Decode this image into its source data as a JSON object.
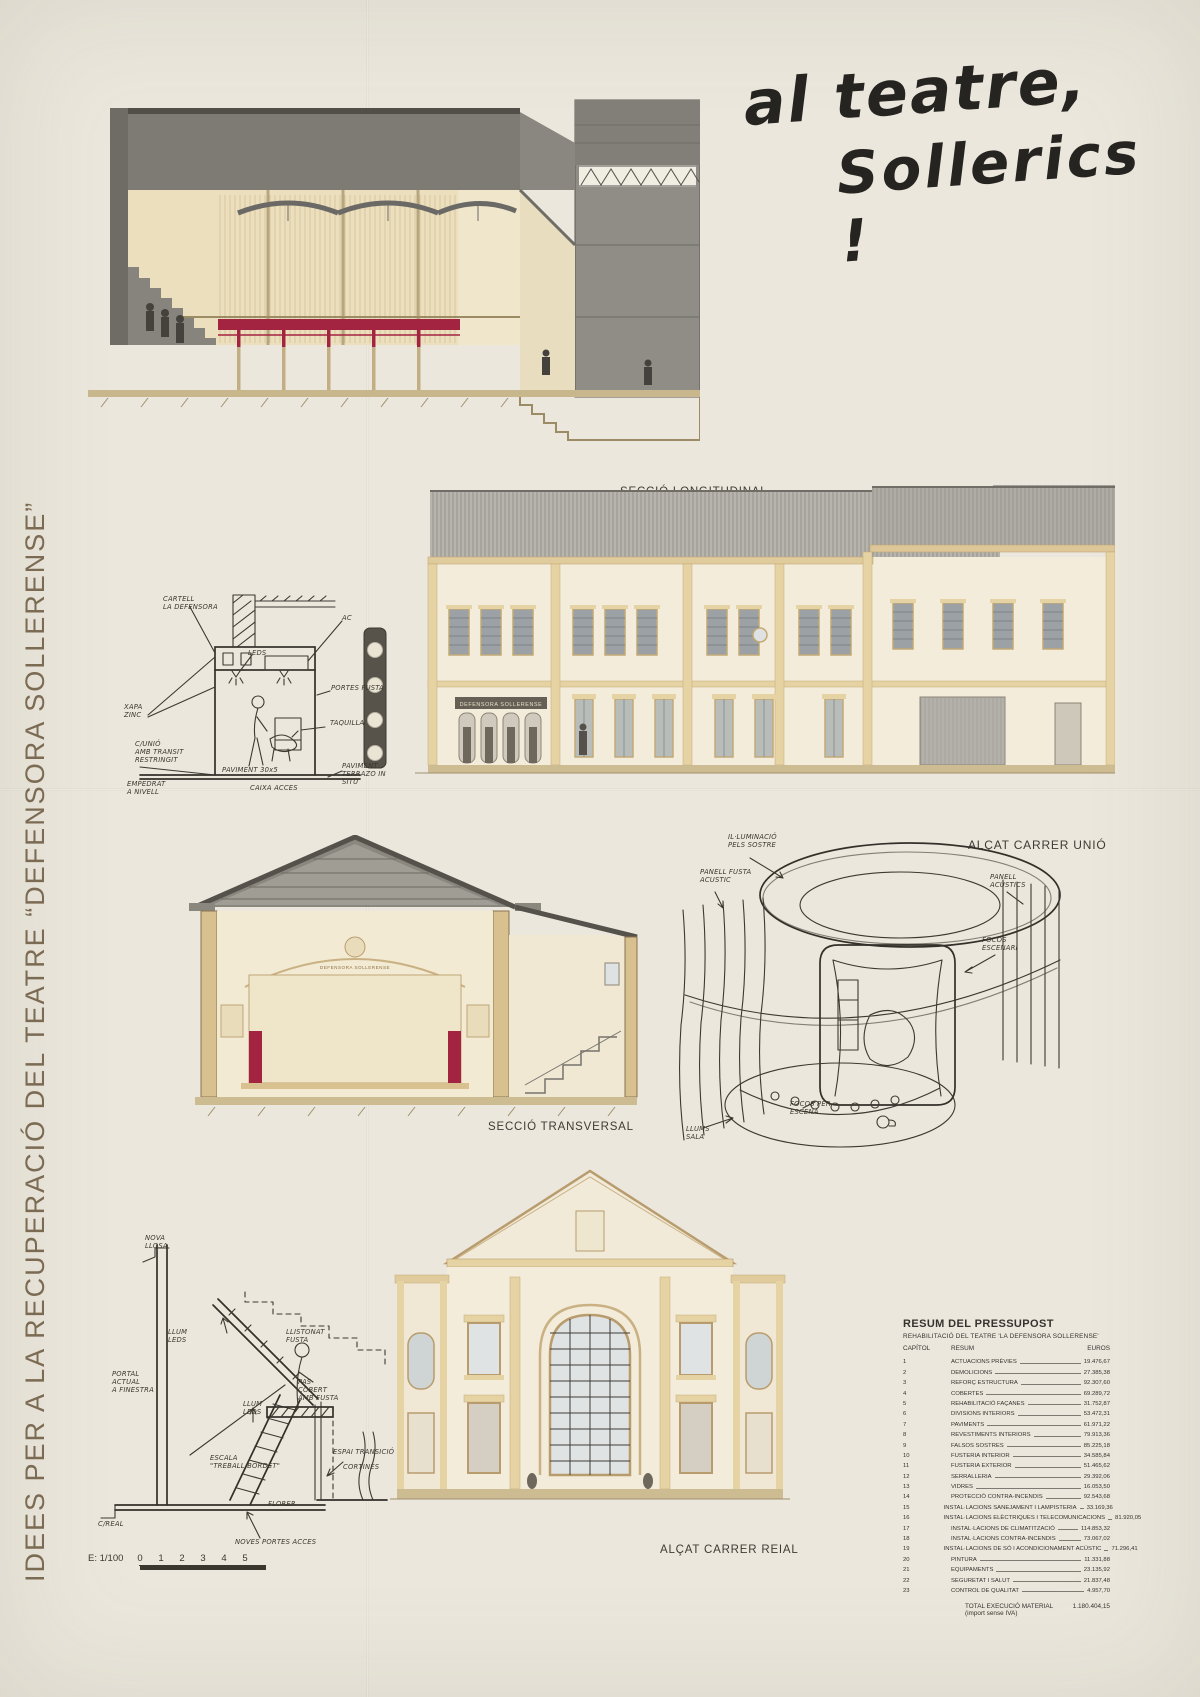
{
  "side_title": "IDEES PER A LA RECUPERACIÓ DEL TEATRE “DEFENSORA SOLLERENSE”",
  "main_title": {
    "line1": "al teatre,",
    "line2": "Sollerics !"
  },
  "drawings": {
    "seccio_longitudinal": "SECCIÓ LONGITUDINAL",
    "alcat_carrer_unio": "ALÇAT CARRER UNIÓ",
    "seccio_transversal": "SECCIÓ TRANSVERSAL",
    "alcat_carrer_reial": "ALÇAT CARRER REIAL"
  },
  "facade_sign": "DEFENSORA SOLLERENSE",
  "sketch_entrance": {
    "cartell": "CARTELL\nLA DEFENSORA",
    "ac": "AC",
    "leds": "LEDS",
    "portes": "PORTES FUSTA",
    "taquilla": "TAQUILLA",
    "xapa": "XAPA\nZINC",
    "carrer_unio": "C/UNIÓ\nAMB TRANSIT\nRESTRINGIT",
    "paviment_terrazo": "PAVIMENT\nTERRAZO IN\nSITU",
    "empedrat": "EMPEDRAT\nA NIVELL",
    "paviment_30": "PAVIMENT 30x5",
    "caixa_acces": "CAIXA ACCES"
  },
  "sketch_perspective": {
    "illuminacio": "IL·LUMINACIÓ\nPELS SOSTRE",
    "panell_fusta": "PANELL FUSTA\nACUSTIC",
    "panell_acustics": "PANELL\nACUSTICS",
    "focos_escenari": "FOCOS\nESCENARI",
    "focos_escena": "FOCOS PER\nESCENA",
    "llums_sala": "LLUMS\nSALA"
  },
  "sketch_stair": {
    "nova_llosa": "NOVA\nLLOSA",
    "llum_leds": "LLUM\nLEDS",
    "llistonat": "LLISTONAT\nFUSTA",
    "portal": "PORTAL\nACTUAL\nA FINESTRA",
    "pas_cobert": "PAS\nCOBERT\nAMB FUSTA",
    "llum_leds2": "LLUM\nLEDS",
    "escala": "ESCALA\n\"TREBALL·BORDET\"",
    "espai_transicio": "ESPAI TRANSICIÓ",
    "cortines": "CORTINES",
    "florer": "FLORER",
    "carrer_real": "C/REAL",
    "noves_portes": "NOVES PORTES ACCES"
  },
  "budget": {
    "title": "RESUM DEL PRESSUPOST",
    "subtitle": "REHABILITACIÓ DEL TEATRE 'LA DEFENSORA SOLLERENSE'",
    "headers": {
      "capitol": "CAPÍTOL",
      "resum": "RESUM",
      "euros": "EUROS"
    },
    "rows": [
      {
        "num": "1",
        "name": "ACTUACIONS PRÈVIES",
        "value": "19.476,67"
      },
      {
        "num": "2",
        "name": "DEMOLICIONS",
        "value": "27.385,38"
      },
      {
        "num": "3",
        "name": "REFORÇ ESTRUCTURA",
        "value": "92.307,60"
      },
      {
        "num": "4",
        "name": "COBERTES",
        "value": "69.289,72"
      },
      {
        "num": "5",
        "name": "REHABILITACIÓ FAÇANES",
        "value": "31.752,87"
      },
      {
        "num": "6",
        "name": "DIVISIONS INTERIORS",
        "value": "53.472,31"
      },
      {
        "num": "7",
        "name": "PAVIMENTS",
        "value": "61.971,22"
      },
      {
        "num": "8",
        "name": "REVESTIMENTS INTERIORS",
        "value": "79.913,36"
      },
      {
        "num": "9",
        "name": "FALSOS SOSTRES",
        "value": "85.225,18"
      },
      {
        "num": "10",
        "name": "FUSTERIA INTERIOR",
        "value": "34.585,84"
      },
      {
        "num": "11",
        "name": "FUSTERIA EXTERIOR",
        "value": "51.465,62"
      },
      {
        "num": "12",
        "name": "SERRALLERIA",
        "value": "29.392,06"
      },
      {
        "num": "13",
        "name": "VIDRES",
        "value": "16.053,50"
      },
      {
        "num": "14",
        "name": "PROTECCIÓ CONTRA-INCENDIS",
        "value": "92.543,68"
      },
      {
        "num": "15",
        "name": "INSTAL·LACIONS SANEJAMENT I LAMPISTERIA",
        "value": "33.169,36"
      },
      {
        "num": "16",
        "name": "INSTAL·LACIONS ELÈCTRIQUES I TELECOMUNICACIONS",
        "value": "81.920,05"
      },
      {
        "num": "17",
        "name": "INSTAL·LACIONS DE CLIMATITZACIÓ",
        "value": "114.853,32"
      },
      {
        "num": "18",
        "name": "INSTAL·LACIONS CONTRA-INCENDIS",
        "value": "73.067,02"
      },
      {
        "num": "19",
        "name": "INSTAL·LACIONS DE SÓ I ACONDICIONAMENT ACÚSTIC",
        "value": "71.296,41"
      },
      {
        "num": "20",
        "name": "PINTURA",
        "value": "11.331,88"
      },
      {
        "num": "21",
        "name": "EQUIPAMENTS",
        "value": "23.135,92"
      },
      {
        "num": "22",
        "name": "SEGURETAT I SALUT",
        "value": "21.837,48"
      },
      {
        "num": "23",
        "name": "CONTROL DE QUALITAT",
        "value": "4.957,70"
      }
    ],
    "total_label": "TOTAL EXECUCIÓ MATERIAL (import sense IVA)",
    "total_value": "1.180.404,15"
  },
  "scale": {
    "label": "E: 1/100",
    "ticks": [
      "0",
      "1",
      "2",
      "3",
      "4",
      "5"
    ]
  },
  "colors": {
    "accent_red": "#a32441",
    "tan": "#b89c6d",
    "ink": "#3c3931",
    "paper": "#ebe7dd"
  }
}
